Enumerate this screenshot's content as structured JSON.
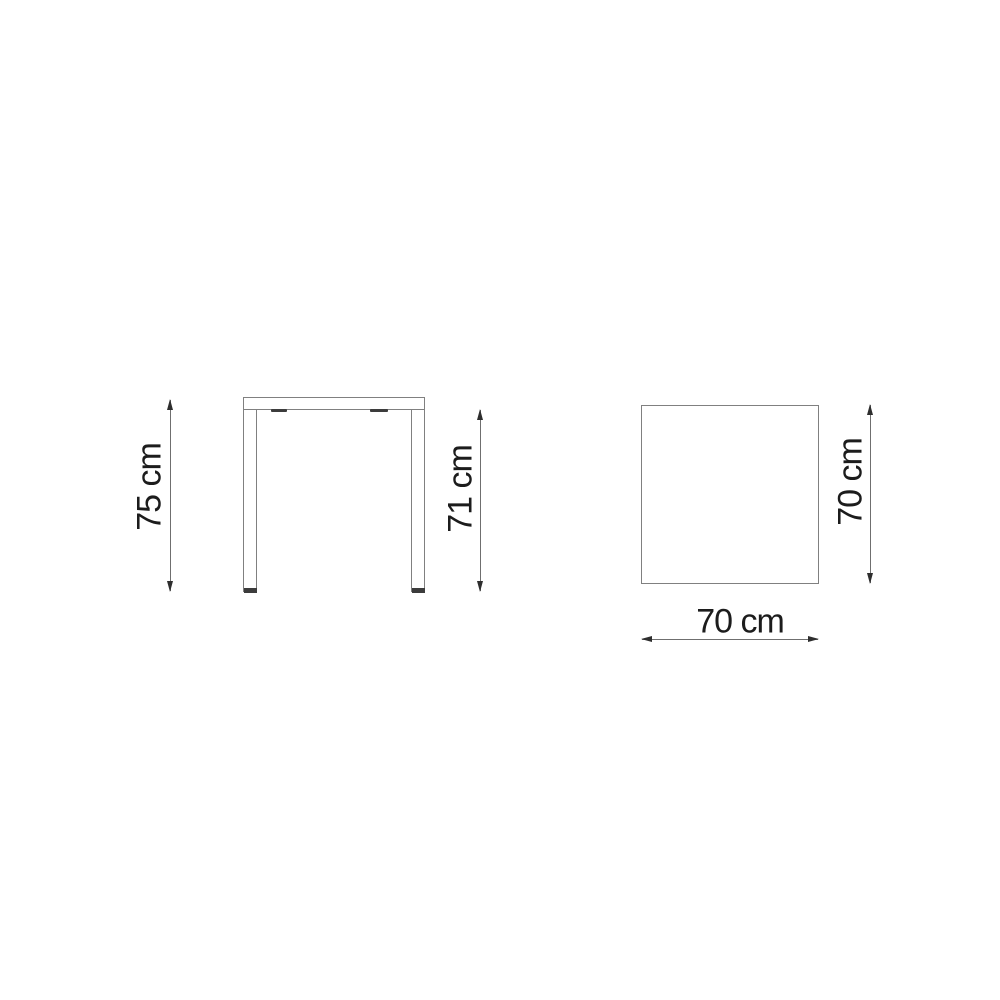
{
  "colors": {
    "background": "#ffffff",
    "drawing_line": "#808080",
    "dimension_line": "#6f6f6f",
    "arrowhead": "#2e2e2e",
    "text": "#1c1c1c",
    "foot": "#3c3c3c"
  },
  "front_view": {
    "total_height_label": "75 cm",
    "under_top_height_label": "71 cm"
  },
  "top_view": {
    "depth_label": "70 cm",
    "width_label": "70 cm"
  }
}
